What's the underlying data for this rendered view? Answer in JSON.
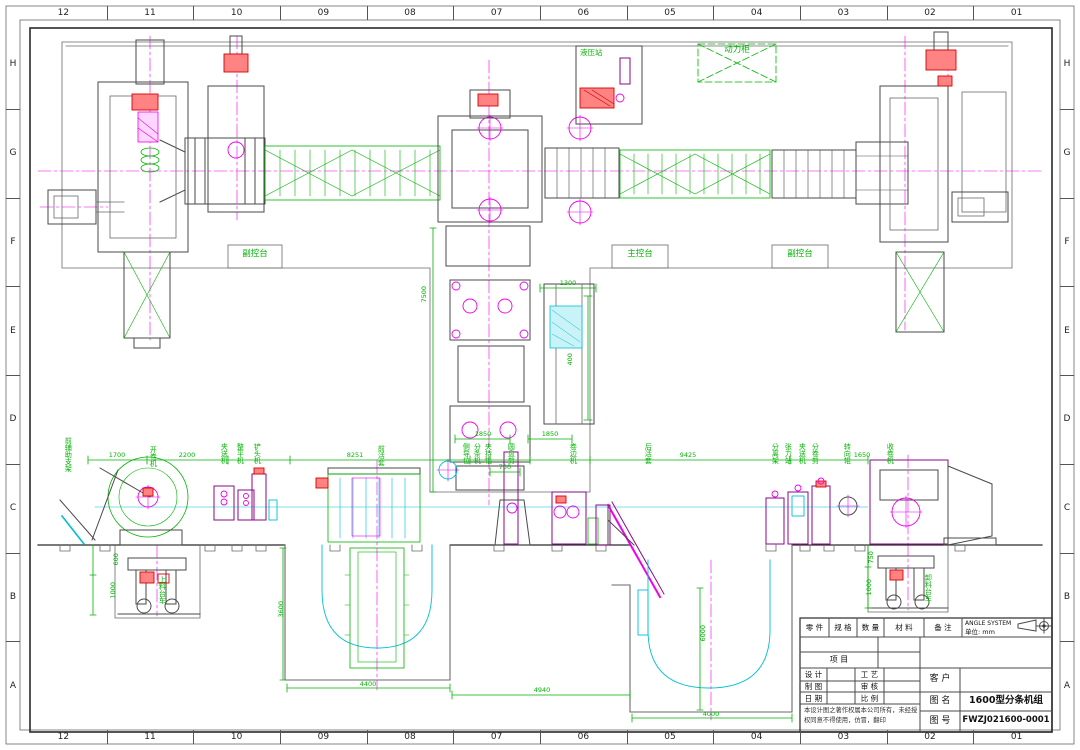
{
  "border": {
    "columns": [
      "12",
      "11",
      "10",
      "09",
      "08",
      "07",
      "06",
      "05",
      "04",
      "03",
      "02",
      "01"
    ],
    "rows": [
      "H",
      "G",
      "F",
      "E",
      "D",
      "C",
      "B",
      "A"
    ]
  },
  "plan_view": {
    "hydraulic_station_label": "液压站",
    "power_cabinet_label": "动力柜",
    "consoles": [
      {
        "label": "副控台"
      },
      {
        "label": "主控台"
      },
      {
        "label": "副控台"
      }
    ],
    "dimensions": {
      "branch_length": "7500",
      "loop_box_width": "1300",
      "loop_box_height": "400"
    }
  },
  "side_view": {
    "equipment_labels": [
      "前辅助支架",
      "开卷机",
      "夹送机",
      "整平机",
      "铲头机",
      "前活套",
      "侧导位",
      "分条机",
      "夹持辊",
      "圆盘剪",
      "卷边机",
      "后活套",
      "分离架",
      "张力站",
      "夹送机",
      "分卷剪",
      "转向辊",
      "收卷机"
    ],
    "cart_labels": [
      "上料台车",
      "卸料台车"
    ],
    "dimensions": {
      "d1700": "1700",
      "d2200": "2200",
      "d8251": "8251",
      "d1850a": "1850",
      "d1850b": "1850",
      "d730": "730",
      "d9425": "9425",
      "d1650": "1650",
      "d600": "600",
      "d1000a": "1000",
      "d750": "750",
      "d1000b": "1000",
      "d3600": "3600",
      "d4400": "4400",
      "d4940": "4940",
      "d6000": "6000",
      "d4000": "4000"
    }
  },
  "title_block": {
    "headers": [
      "零 件",
      "规 格",
      "数 量",
      "材 料",
      "备 注"
    ],
    "angle_system": "ANGLE SYSTEM",
    "unit": "单位: mm",
    "project": "项 目",
    "design": "设 计",
    "draft": "制 图",
    "date": "日 期",
    "process": "工 艺",
    "review": "审 核",
    "scale": "比 例",
    "customer": "客 户",
    "drawing_name_label": "图 名",
    "drawing_name": "1600型分条机组",
    "drawing_no_label": "图 号",
    "drawing_no": "FWZJ021600-0001",
    "copyright_line1": "本设计图之著作权属本公司所有，未经授",
    "copyright_line2": "权同意不得使用，仿冒，翻印"
  }
}
